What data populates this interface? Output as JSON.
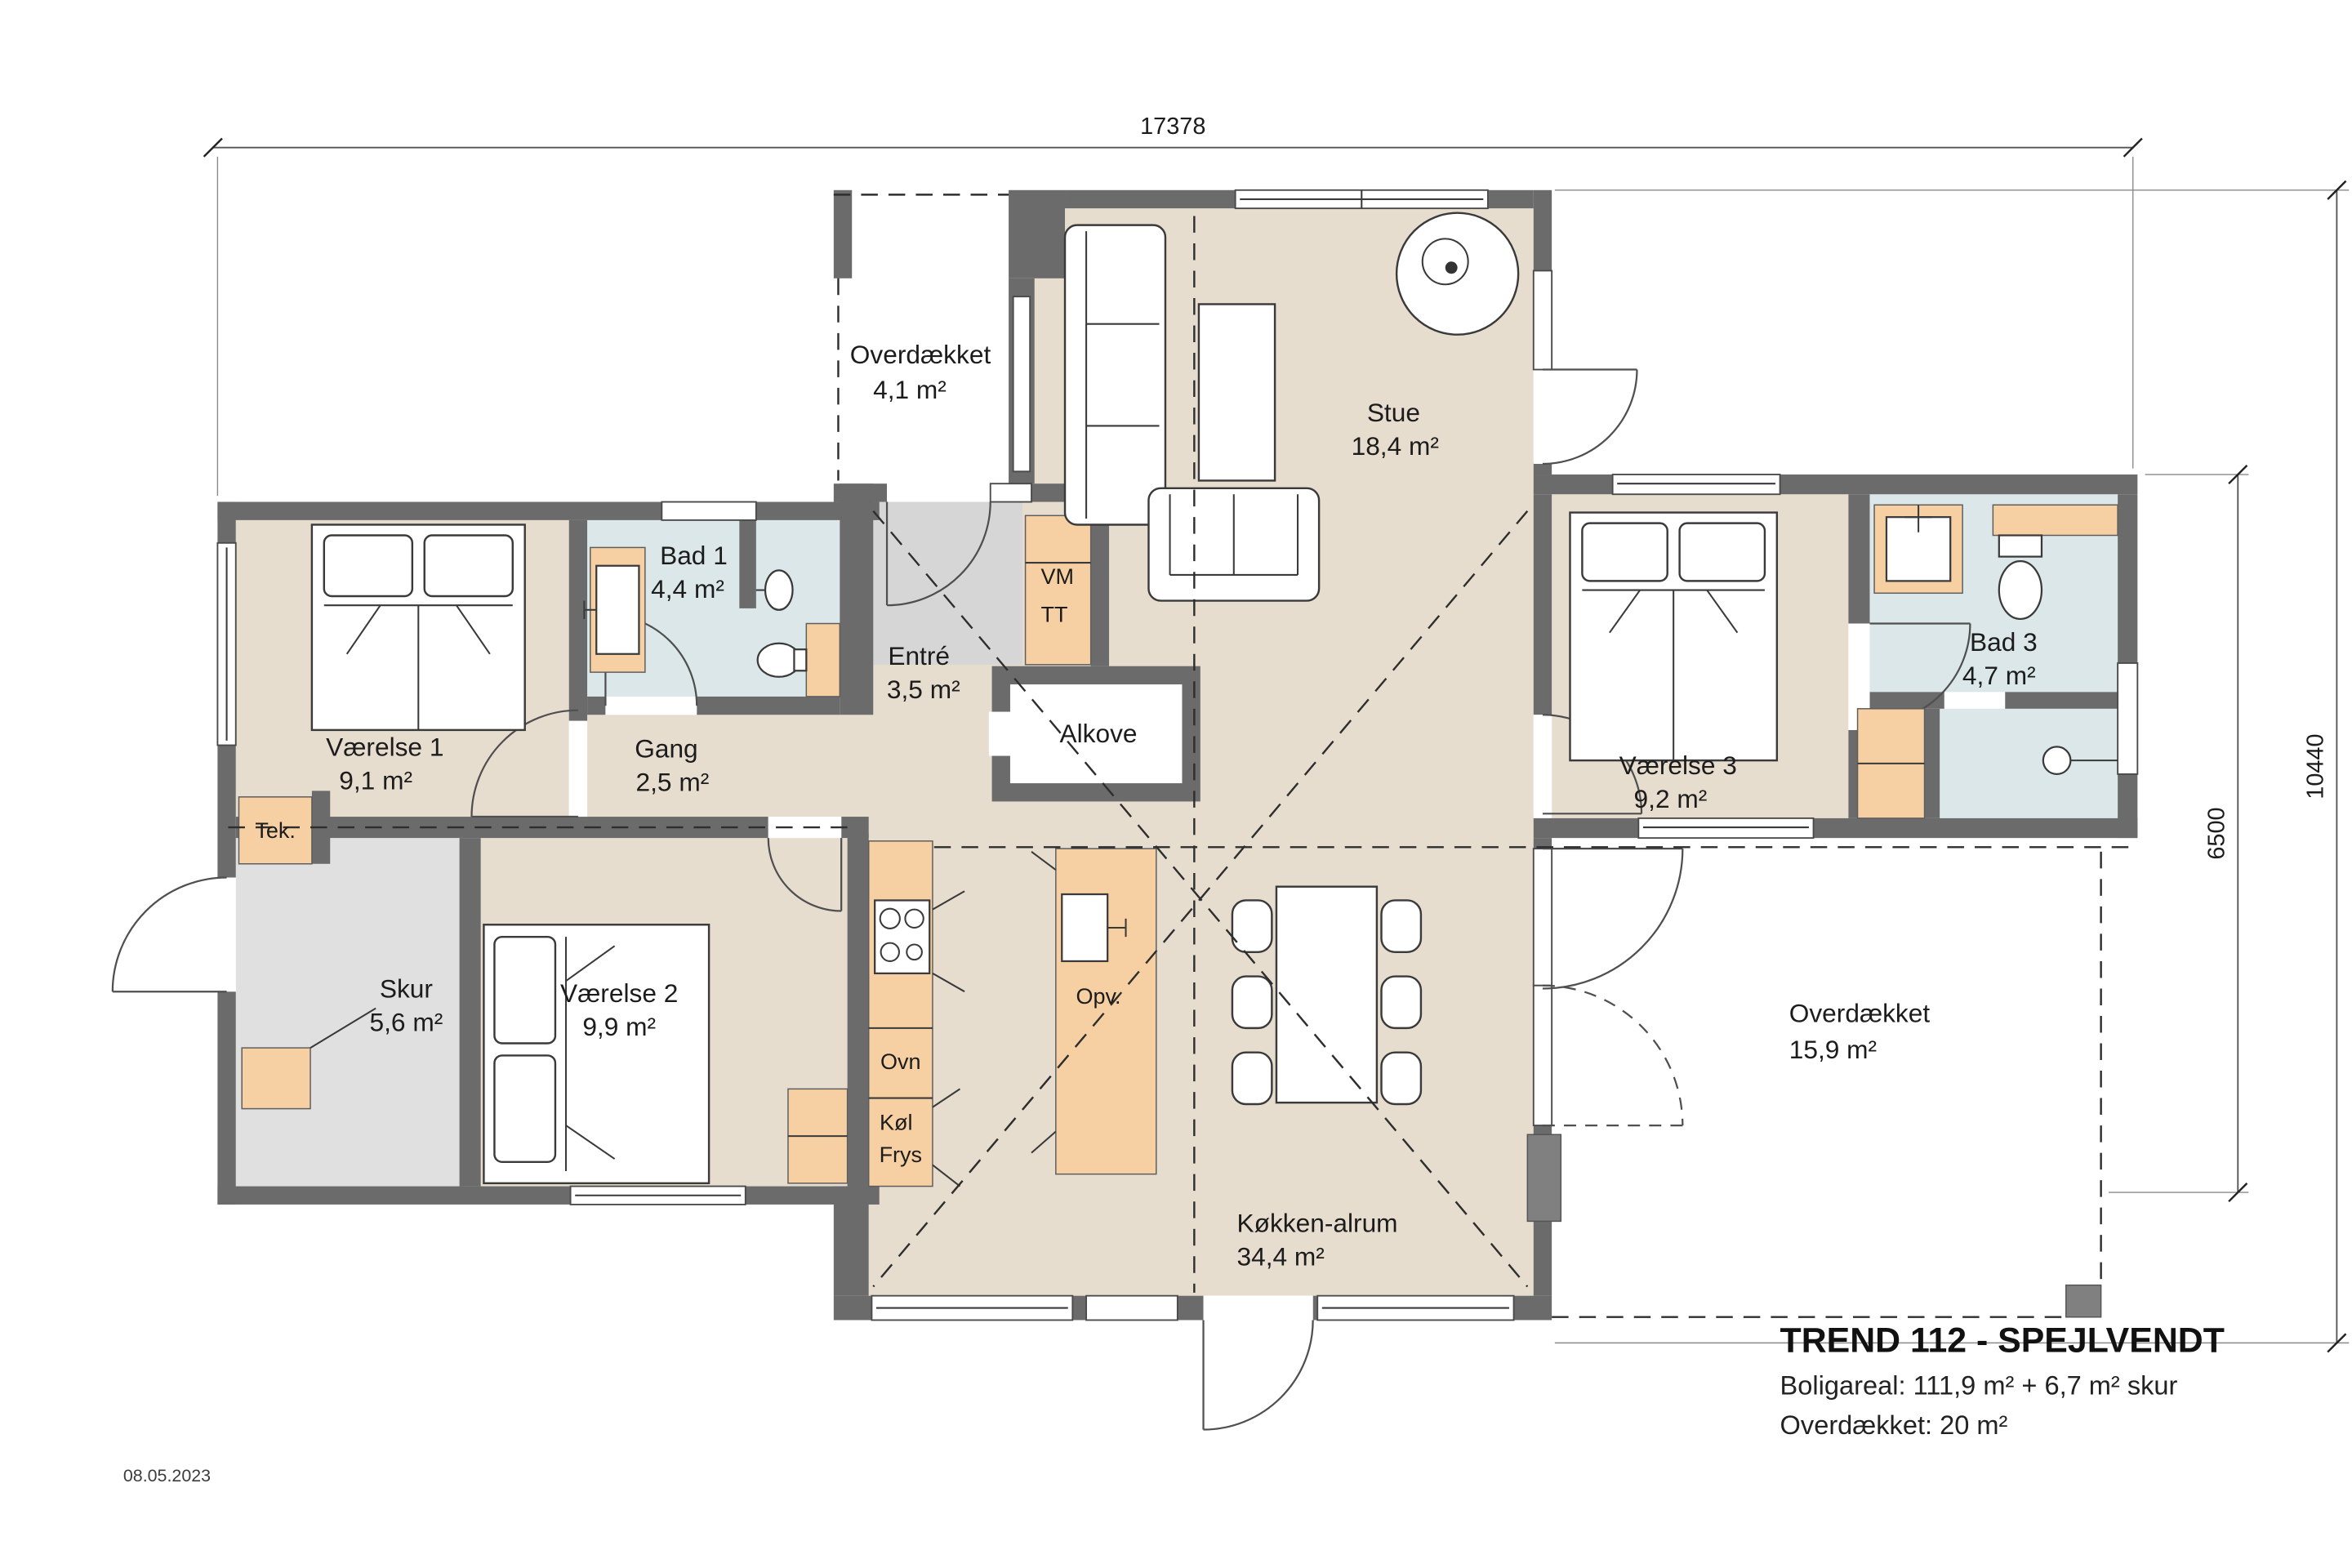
{
  "meta": {
    "date": "08.05.2023"
  },
  "title_block": {
    "title": "TREND 112 - SPEJLVENDT",
    "line1": "Boligareal: 111,9 m² + 6,7 m² skur",
    "line2": "Overdækket: 20 m²"
  },
  "dimensions": {
    "top": "17378",
    "right_outer": "10440",
    "right_inner": "6500"
  },
  "rooms": {
    "overdaekket_top": {
      "name": "Overdækket",
      "area": "4,1 m²"
    },
    "stue": {
      "name": "Stue",
      "area": "18,4 m²"
    },
    "bad1": {
      "name": "Bad 1",
      "area": "4,4 m²"
    },
    "entre": {
      "name": "Entré",
      "area": "3,5 m²"
    },
    "alkove": {
      "name": "Alkove"
    },
    "vaerelse1": {
      "name": "Værelse 1",
      "area": "9,1 m²"
    },
    "gang": {
      "name": "Gang",
      "area": "2,5 m²"
    },
    "vaerelse2": {
      "name": "Værelse 2",
      "area": "9,9 m²"
    },
    "vaerelse3": {
      "name": "Værelse 3",
      "area": "9,2 m²"
    },
    "bad3": {
      "name": "Bad 3",
      "area": "4,7 m²"
    },
    "tek": {
      "name": "Tek."
    },
    "skur": {
      "name": "Skur",
      "area": "5,6 m²"
    },
    "koekken_alrum": {
      "name": "Køkken-alrum",
      "area": "34,4 m²"
    },
    "overdaekket_terrasse": {
      "name": "Overdækket",
      "area": "15,9 m²"
    }
  },
  "appliances": {
    "vm": "VM",
    "tt": "TT",
    "ovn": "Ovn",
    "koel": "Køl",
    "frys": "Frys",
    "opv": "Opv."
  },
  "colors": {
    "floor_beige": "#e7ddcf",
    "floor_gray": "#e0e0e0",
    "floor_entre": "#d6d6d6",
    "bath_blue": "#dbe7e9",
    "cabinet_orange": "#f6d0a2",
    "wall_dark": "#6b6b6b",
    "line": "#333333",
    "accent_post": "#808080"
  }
}
